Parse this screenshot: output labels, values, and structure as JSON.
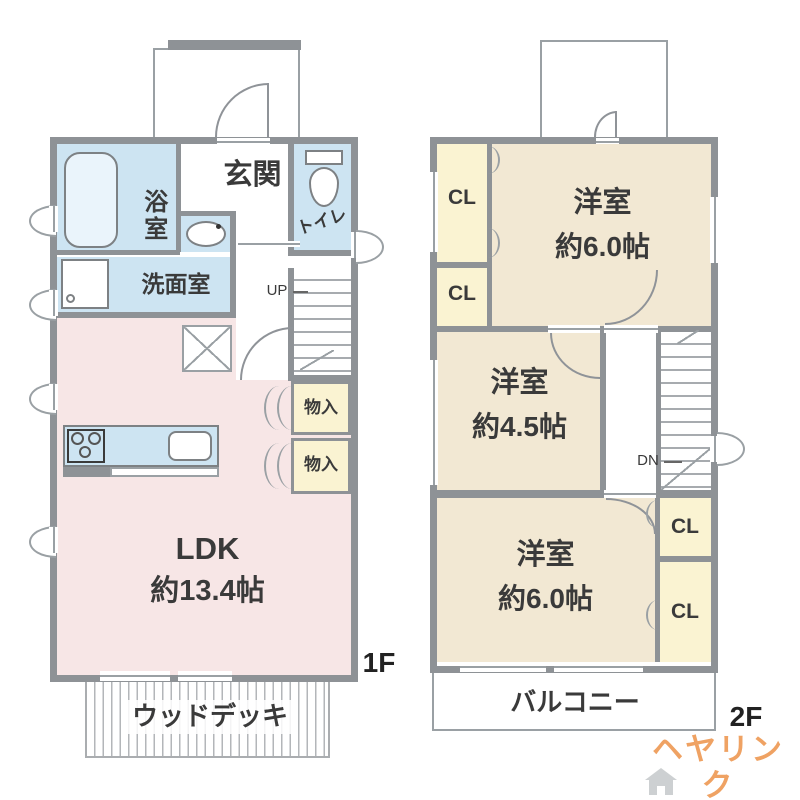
{
  "logo": {
    "text": "ヘヤリンク"
  },
  "floor1": {
    "floor_label": "1F",
    "entrance": "玄関",
    "bath": "浴室",
    "washroom": "洗面室",
    "toilet": "トイレ",
    "stairs_up": "UP",
    "storage_top": "物入",
    "storage_bottom": "物入",
    "ldk_name": "LDK",
    "ldk_size": "約13.4帖",
    "wood_deck": "ウッドデッキ"
  },
  "floor2": {
    "floor_label": "2F",
    "closet_top_1": "CL",
    "closet_top_2": "CL",
    "closet_bottom_1": "CL",
    "closet_bottom_2": "CL",
    "bedroom_top_name": "洋室",
    "bedroom_top_size": "約6.0帖",
    "bedroom_mid_name": "洋室",
    "bedroom_mid_size": "約4.5帖",
    "bedroom_bottom_name": "洋室",
    "bedroom_bottom_size": "約6.0帖",
    "stairs_down": "DN",
    "balcony": "バルコニー"
  },
  "colors": {
    "wall": "#8e9296",
    "ldk_fill": "#f7e6e6",
    "wet_area_fill": "#cde4f2",
    "bedroom_fill": "#f2e8d3",
    "closet_fill": "#faf3d2",
    "logo_orange": "#efa263"
  }
}
